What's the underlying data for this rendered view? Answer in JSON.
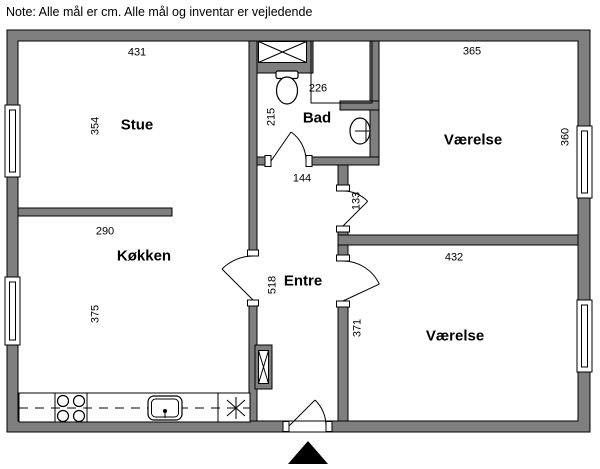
{
  "note": "Note: Alle mål er cm. Alle mål og inventar er vejledende",
  "wall_color": "#7f7f7f",
  "rooms": {
    "stue": "Stue",
    "bad": "Bad",
    "kokken": "Køkken",
    "entre": "Entre",
    "vaerelse_top": "Værelse",
    "vaerelse_bottom": "Værelse"
  },
  "dims": {
    "stue_width": "431",
    "stue_height": "354",
    "stue_kokken_wall": "290",
    "kokken_height": "375",
    "bad_width": "226",
    "bad_height": "215",
    "entre_width": "144",
    "entre_length": "518",
    "vaerelse_top_door": "133",
    "vaerelse_top_width": "365",
    "vaerelse_top_height": "360",
    "vaerelse_bottom_width": "432",
    "vaerelse_bottom_height": "371"
  }
}
